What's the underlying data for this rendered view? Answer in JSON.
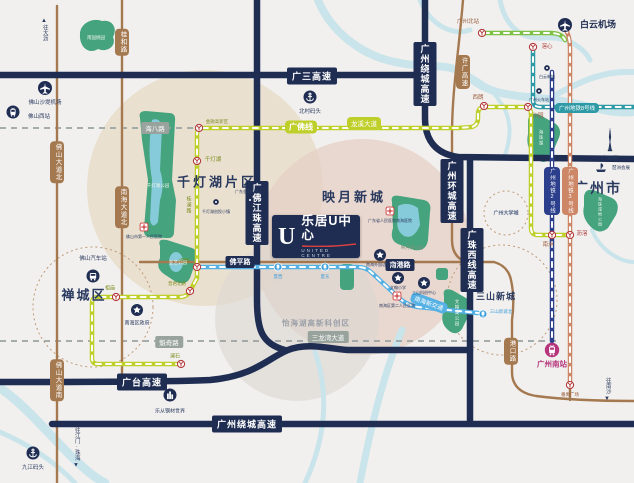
{
  "logo": {
    "mark": "U",
    "title": "乐居U中心",
    "subtitle": "UNITED CENTRE",
    "accent": "#d94040"
  },
  "areas": [
    {
      "t": "千灯湖片区",
      "x": 217,
      "y": 181,
      "s": 13,
      "c": "#2a3a5f",
      "ls": 3
    },
    {
      "t": "映月新城",
      "x": 354,
      "y": 196,
      "s": 13,
      "c": "#2a3a5f",
      "ls": 3
    },
    {
      "t": "禅城区",
      "x": 84,
      "y": 294,
      "s": 13,
      "c": "#2a3a5f",
      "ls": 2
    },
    {
      "t": "广州市",
      "x": 598,
      "y": 188,
      "s": 14,
      "c": "#2a3a5f",
      "ls": 2
    },
    {
      "t": "三山新城",
      "x": 496,
      "y": 296,
      "s": 9,
      "c": "#2a3a5f",
      "ls": 1
    },
    {
      "t": "怡海湖高新科创区",
      "x": 316,
      "y": 323,
      "s": 7.5,
      "c": "#9aa0a8",
      "ls": 1
    },
    {
      "t": "广州大学城",
      "x": 506,
      "y": 213,
      "s": 5,
      "c": "#5a6b8c",
      "ls": 0
    }
  ],
  "highway_labels": [
    {
      "t": "广三高速",
      "x": 312,
      "y": 76,
      "vert": false
    },
    {
      "t": "广州绕城高速",
      "x": 425,
      "y": 74,
      "vert": true
    },
    {
      "t": "广佛江珠高速",
      "x": 257,
      "y": 213,
      "vert": true
    },
    {
      "t": "广州环城高速",
      "x": 452,
      "y": 191,
      "vert": true
    },
    {
      "t": "广珠西线高速",
      "x": 472,
      "y": 260,
      "vert": true
    },
    {
      "t": "广台高速",
      "x": 142,
      "y": 382,
      "vert": false
    },
    {
      "t": "广州绕城高速",
      "x": 247,
      "y": 424,
      "vert": false
    },
    {
      "t": "佛平路",
      "x": 240,
      "y": 262,
      "vert": false,
      "small": true
    },
    {
      "t": "南港路",
      "x": 400,
      "y": 265,
      "vert": false,
      "small": true
    }
  ],
  "road_pills": [
    {
      "t": "桂和路",
      "x": 122,
      "y": 42
    },
    {
      "t": "许广高速",
      "x": 463,
      "y": 72
    },
    {
      "t": "佛山大道北",
      "x": 57,
      "y": 162
    },
    {
      "t": "南海大道北",
      "x": 122,
      "y": 207
    },
    {
      "t": "佛山大道南",
      "x": 57,
      "y": 380
    },
    {
      "t": "港口路",
      "x": 511,
      "y": 351
    }
  ],
  "street_labels": [
    {
      "t": "海八路",
      "x": 155,
      "y": 128
    },
    {
      "t": "魁奇路",
      "x": 169,
      "y": 342
    },
    {
      "t": "三龙湾大道",
      "x": 328,
      "y": 337
    }
  ],
  "green_texts": [
    {
      "t": "桂澜路",
      "x": 189,
      "y": 205
    }
  ],
  "line_labels": [
    {
      "t": "广佛线",
      "x": 301,
      "y": 127,
      "bg": "#bfcf2a",
      "s": 8,
      "bold": true,
      "vert": false,
      "rot": 0
    },
    {
      "t": "龙溪大道",
      "x": 364,
      "y": 123,
      "bg": "#bfcf2a",
      "s": 6.5,
      "bold": false,
      "vert": false,
      "rot": 0
    },
    {
      "t": "广州地铁8号线",
      "x": 577,
      "y": 108,
      "bg": "#2e9aa6",
      "s": 5.5,
      "bold": false,
      "vert": false,
      "rot": 0
    },
    {
      "t": "广州地铁2号线",
      "x": 552,
      "y": 191,
      "bg": "#2b3f8c",
      "s": 5.5,
      "bold": false,
      "vert": true,
      "rot": 0
    },
    {
      "t": "广州地铁3号线",
      "x": 570,
      "y": 191,
      "bg": "#cd8666",
      "s": 5.5,
      "bold": false,
      "vert": true,
      "rot": 0
    },
    {
      "t": "南海新交通",
      "x": 429,
      "y": 303,
      "bg": "#55b1e4",
      "s": 6,
      "bold": false,
      "vert": false,
      "rot": 20
    }
  ],
  "stations": [
    {
      "t": "广州北站",
      "k": "metro",
      "x": 482,
      "y": 33,
      "lx": 468,
      "ly": 21,
      "lc": "#9a5b3c",
      "ls": 5.5
    },
    {
      "t": "滘心",
      "k": "metro",
      "x": 533,
      "y": 47,
      "lx": 547,
      "ly": 46,
      "lc": "#b03a3a",
      "ls": 5.5
    },
    {
      "t": "西朗",
      "k": "metro",
      "x": 484,
      "y": 106,
      "lx": 478,
      "ly": 97,
      "lc": "#9a5b3c",
      "ls": 5.5
    },
    {
      "t": "沙园",
      "k": "metro",
      "x": 528,
      "y": 107,
      "lx": 538,
      "ly": 115,
      "lc": "#9a5b3c",
      "ls": 5.5
    },
    {
      "t": "南洲",
      "k": "metro",
      "x": 552,
      "y": 235,
      "lx": 548,
      "ly": 244,
      "lc": "#9a5b3c",
      "ls": 5.5
    },
    {
      "t": "沥滘",
      "k": "metro",
      "x": 570,
      "y": 235,
      "lx": 582,
      "ly": 233,
      "lc": "#b03a3a",
      "ls": 5.5
    },
    {
      "t": "番禺广场",
      "k": "metro",
      "x": 570,
      "y": 385,
      "lx": 570,
      "ly": 395,
      "lc": "#9a5b3c",
      "ls": 4.5
    },
    {
      "t": "千灯湖",
      "k": "metro",
      "x": 197,
      "y": 161,
      "lx": 213,
      "ly": 159,
      "lc": "#7c8c1e",
      "ls": 5.5
    },
    {
      "t": "金融高新区",
      "k": "metro",
      "x": 199,
      "y": 128,
      "lx": 217,
      "ly": 122,
      "lc": "#7c8c1e",
      "ls": 4.5
    },
    {
      "t": "㘵岗",
      "k": "metro",
      "x": 197,
      "y": 267,
      "lx": 184,
      "ly": 261,
      "lc": "#7c8c1e",
      "ls": 5
    },
    {
      "t": "普君北路",
      "k": "metro",
      "x": 190,
      "y": 291,
      "lx": 177,
      "ly": 284,
      "lc": "#7c8c1e",
      "ls": 4.5
    },
    {
      "t": "祖庙",
      "k": "metro",
      "x": 116,
      "y": 297,
      "lx": 110,
      "ly": 288,
      "lc": "#7c8c1e",
      "ls": 5
    },
    {
      "t": "澜石",
      "k": "metro",
      "x": 181,
      "y": 364,
      "lx": 175,
      "ly": 356,
      "lc": "#7c8c1e",
      "ls": 5
    },
    {
      "t": "夏西",
      "k": "nh",
      "x": 278,
      "y": 267,
      "lx": 278,
      "ly": 277,
      "lc": "#3f9fdc",
      "ls": 4.5
    },
    {
      "t": "夏东",
      "k": "nh",
      "x": 325,
      "y": 267,
      "lx": 325,
      "ly": 277,
      "lc": "#3f9fdc",
      "ls": 4.5
    },
    {
      "t": "三山新城北",
      "k": "nh",
      "x": 483,
      "y": 314,
      "lx": 501,
      "ly": 312,
      "lc": "#3f9fdc",
      "ls": 4.5
    },
    {
      "t": "广州南站",
      "k": "hsr",
      "x": 552,
      "y": 350,
      "lx": 552,
      "ly": 364,
      "lc": "#b5347c",
      "ls": 7.5
    }
  ],
  "pois": [
    {
      "t": "白云机场",
      "icon": "plane",
      "x": 565,
      "y": 25,
      "lx": 598,
      "ly": 24,
      "ls": 9,
      "lc": "#1f2d52",
      "bold": true
    },
    {
      "t": "佛山沙堤机场",
      "icon": "plane",
      "x": 45,
      "y": 88,
      "lx": 45,
      "ly": 102,
      "ls": 5.5,
      "lc": "#2a3a5f"
    },
    {
      "t": "佛山西站",
      "icon": "train",
      "x": 13,
      "y": 112,
      "lx": 39,
      "ly": 116,
      "ls": 5.5,
      "lc": "#2a3a5f"
    },
    {
      "t": "北村码头",
      "icon": "anchor",
      "x": 310,
      "y": 97,
      "lx": 310,
      "ly": 111,
      "ls": 5.5,
      "lc": "#2a3a5f"
    },
    {
      "t": "九江码头",
      "icon": "anchor",
      "x": 33,
      "y": 453,
      "lx": 33,
      "ly": 467,
      "ls": 5.5,
      "lc": "#2a3a5f"
    },
    {
      "t": "佛山汽车站",
      "icon": "bus",
      "x": 93,
      "y": 276,
      "lx": 93,
      "ly": 258,
      "ls": 5.5,
      "lc": "#2a3a5f"
    },
    {
      "t": "南海区政府",
      "icon": "star",
      "x": 137,
      "y": 310,
      "lx": 137,
      "ly": 323,
      "ls": 5,
      "lc": "#2a3a5f"
    },
    {
      "t": "乐从钢材世界",
      "icon": "building",
      "x": 170,
      "y": 395,
      "lx": 170,
      "ly": 411,
      "ls": 5,
      "lc": "#2a3a5f"
    },
    {
      "t": "广州塔",
      "icon": "tower",
      "x": 610,
      "y": 140,
      "lx": 610,
      "ly": 158,
      "ls": 5.5,
      "lc": "#2a3a5f"
    },
    {
      "t": "琶洲会展",
      "icon": "expo",
      "x": 601,
      "y": 168,
      "lx": 621,
      "ly": 168,
      "ls": 4.5,
      "lc": "#2a3a5f"
    },
    {
      "t": "白云新城",
      "icon": "dot",
      "x": 547,
      "y": 68,
      "lx": 547,
      "ly": 77,
      "ls": 4,
      "lc": "#2a3a5f"
    },
    {
      "t": "广州火车站",
      "icon": "dot",
      "x": 539,
      "y": 91,
      "lx": 539,
      "ly": 100,
      "ls": 4,
      "lc": "#2a3a5f"
    },
    {
      "t": "千灯湖创投小镇",
      "icon": "dot",
      "x": 216,
      "y": 202,
      "lx": 216,
      "ly": 212,
      "ls": 4,
      "lc": "#2a3a5f"
    },
    {
      "t": "广东金融高新区",
      "icon": "dot",
      "x": 250,
      "y": 200,
      "lx": 249,
      "ly": 192,
      "ls": 4,
      "lc": "#2a3a5f"
    },
    {
      "t": "佛山市第一人民医院",
      "icon": "cross",
      "x": 144,
      "y": 227,
      "lx": 144,
      "ly": 237,
      "ls": 4,
      "lc": "#2a3a5f"
    },
    {
      "t": "广东省人民医院南海医院",
      "icon": "cross",
      "x": 390,
      "y": 211,
      "lx": 390,
      "ly": 221,
      "ls": 4,
      "lc": "#2a3a5f"
    },
    {
      "t": "南海区第二人民医院",
      "icon": "cross",
      "x": 397,
      "y": 296,
      "lx": 397,
      "ly": 306,
      "ls": 4,
      "lc": "#2a3a5f"
    },
    {
      "t": "南海外国语学校",
      "icon": "star",
      "x": 380,
      "y": 255,
      "lx": 380,
      "ly": 265,
      "ls": 4,
      "lc": "#2a3a5f"
    },
    {
      "t": "文翰小学",
      "icon": "star",
      "x": 398,
      "y": 278,
      "lx": 398,
      "ly": 288,
      "ls": 4,
      "lc": "#2a3a5f"
    },
    {
      "t": "三山科创中心",
      "icon": "star",
      "x": 424,
      "y": 283,
      "lx": 424,
      "ly": 293,
      "ls": 4,
      "lc": "#2a3a5f"
    }
  ],
  "park_labels": [
    {
      "t": "南国桃园",
      "x": 96,
      "y": 38,
      "c": "#eef5ee",
      "s": 4.5,
      "vert": false
    },
    {
      "t": "千灯湖公园",
      "x": 158,
      "y": 186,
      "c": "#eef5ee",
      "s": 4.5,
      "vert": false
    },
    {
      "t": "亚艺公园",
      "x": 178,
      "y": 263,
      "c": "#eef5ee",
      "s": 4.5,
      "vert": false
    },
    {
      "t": "映月湖公园",
      "x": 412,
      "y": 248,
      "c": "#7e937e",
      "s": 4.5,
      "vert": false
    },
    {
      "t": "文翰湖公园",
      "x": 457,
      "y": 313,
      "c": "#eef5ee",
      "s": 4.5,
      "vert": true
    },
    {
      "t": "海珠湖",
      "x": 541,
      "y": 138,
      "c": "#eef5ee",
      "s": 4.5,
      "vert": true
    },
    {
      "t": "海珠湿地公园",
      "x": 600,
      "y": 212,
      "c": "#eef5ee",
      "s": 4,
      "vert": true
    }
  ],
  "arrows": [
    {
      "t": "往大沥",
      "x": 44,
      "y": 30,
      "dir": "up"
    },
    {
      "t": "往江门·珠海",
      "x": 76,
      "y": 447,
      "dir": "down"
    },
    {
      "t": "往南沙",
      "x": 607,
      "y": 389,
      "dir": "down"
    }
  ],
  "colors": {
    "navy_road": "#1f2d52",
    "brown_road": "#a5794f",
    "gz_foshan_line": "#bfcf2a",
    "line2": "#2b3f8c",
    "line3": "#cd8666",
    "line8": "#2e9aa6",
    "line9": "#7cc142",
    "nh_transit": "#55b1e4",
    "park": "#45a37e",
    "water": "#c9e4ea",
    "accent_red": "#d94040"
  }
}
